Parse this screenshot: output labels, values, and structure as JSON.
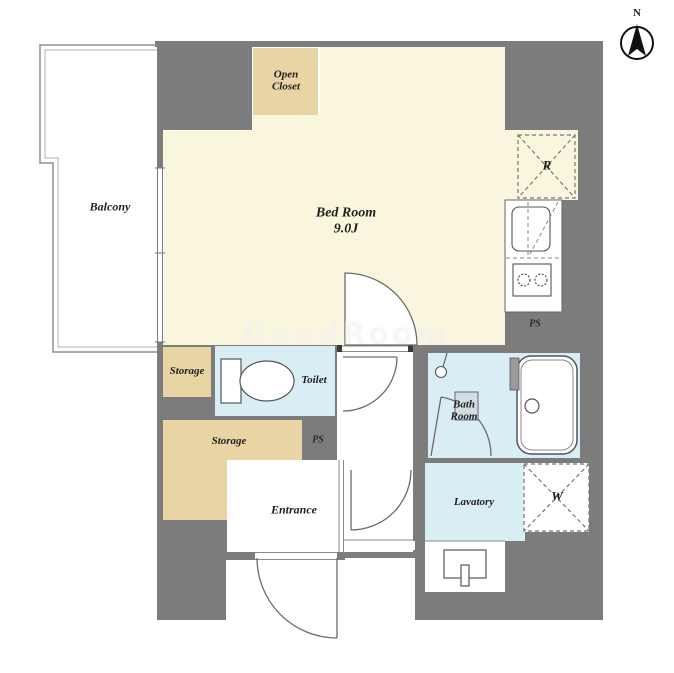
{
  "plan": {
    "title": "1K apartment floor plan",
    "compass": {
      "north_label": "N"
    },
    "watermark": "GoodRoom",
    "rooms": {
      "balcony": {
        "label": "Balcony"
      },
      "bedroom": {
        "label": "Bed Room",
        "size": "9.0J"
      },
      "open_closet": {
        "label_line1": "Open",
        "label_line2": "Closet"
      },
      "storage_small": {
        "label": "Storage"
      },
      "storage_large": {
        "label": "Storage"
      },
      "toilet": {
        "label": "Toilet"
      },
      "bathroom": {
        "label_line1": "Bath",
        "label_line2": "Room"
      },
      "lavatory": {
        "label": "Lavatory"
      },
      "entrance": {
        "label": "Entrance"
      }
    },
    "annotations": {
      "ps_hall": "PS",
      "ps_kitchen": "PS",
      "refrigerator_space": "R",
      "washer_space": "W"
    },
    "colors": {
      "wall_gray": "#7C7C7C",
      "floor_cream": "#FAF6DE",
      "closet_tan": "#E9D4A4",
      "wet_area_blue": "#D9EDF4",
      "fixture_line": "#555555",
      "label_text": "#1F1F1F"
    }
  }
}
